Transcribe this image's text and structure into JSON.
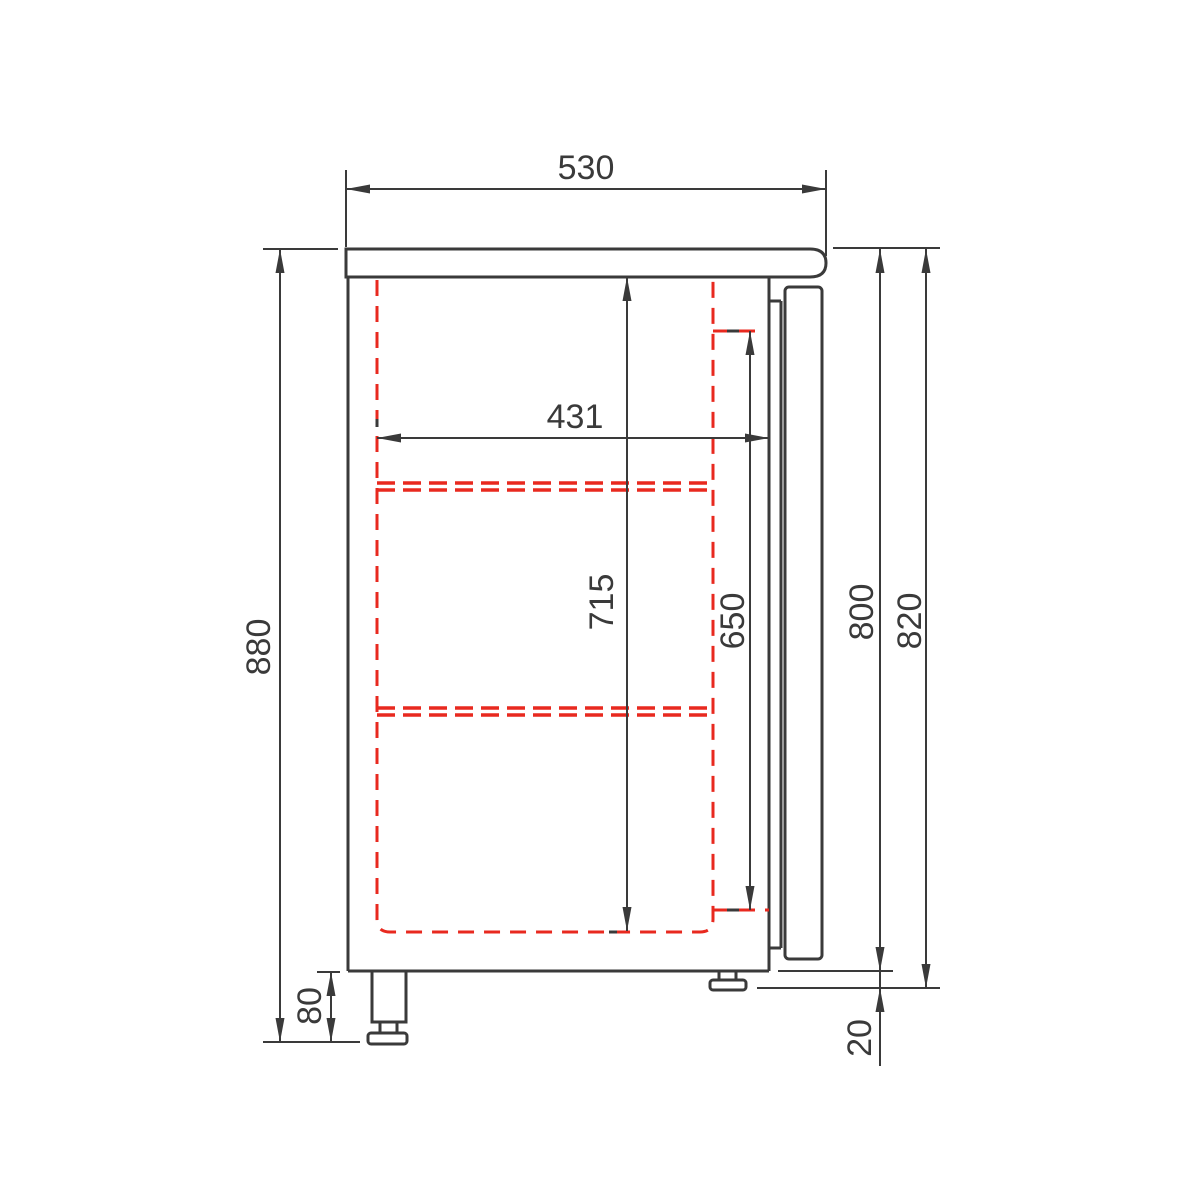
{
  "colors": {
    "line": "#3a3a3a",
    "hidden": "#e8291f",
    "text": "#3a3a3a",
    "bg": "#ffffff"
  },
  "dimensions": {
    "top_depth": "530",
    "interior_depth": "431",
    "interior_height": "715",
    "door_opening_height": "650",
    "overall_height": "880",
    "foot_height": "80",
    "body_height": "800",
    "body_plus_door_height": "820",
    "door_overhang": "20"
  }
}
